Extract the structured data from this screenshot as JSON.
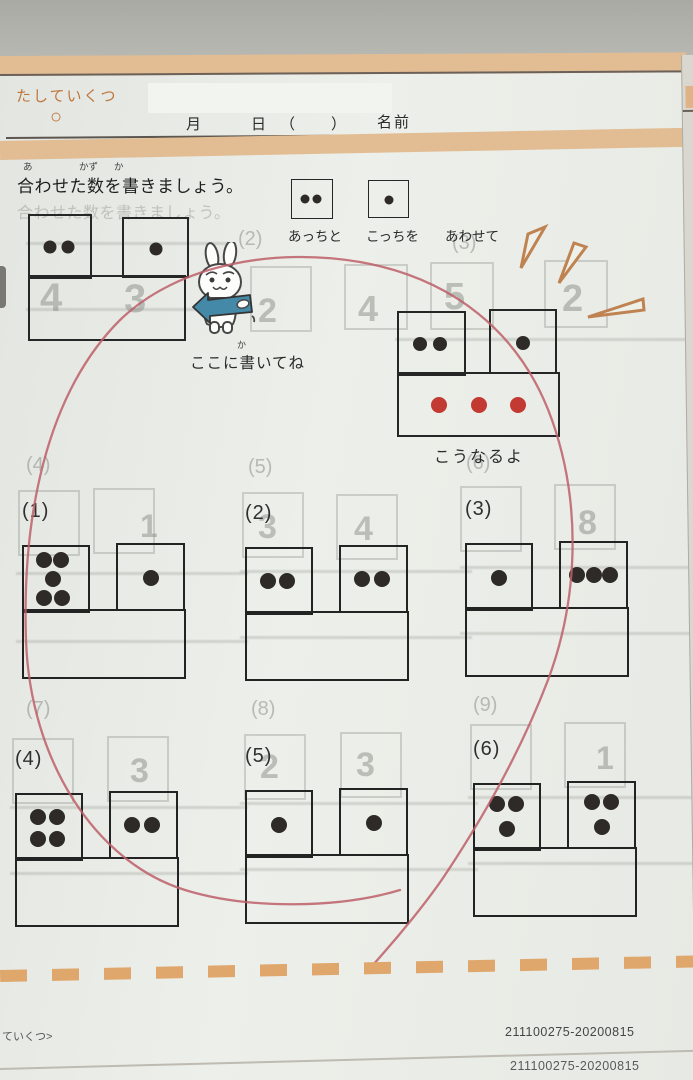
{
  "colors": {
    "accent_orange_bar": "#e2bc92",
    "title_orange": "#c0763e",
    "red_pen": "#bd5f68",
    "dot_black": "#2e2a27",
    "dot_red": "#c23a32",
    "arrow_blue": "#4589a8",
    "burst_orange": "#bf8352"
  },
  "header": {
    "title": "たしていくつ",
    "title_mark": "○",
    "month": "月",
    "day": "日",
    "paren_open": "（",
    "paren_close": "）",
    "name": "名前"
  },
  "instruction": {
    "furigana": [
      "あ",
      "かず",
      "か"
    ],
    "text": "合わせた数を書きましょう。",
    "ghost_text": "合わせた数を書きましょう。"
  },
  "legend": {
    "box_a": {
      "count": 2,
      "pattern": "row2"
    },
    "box_b": {
      "count": 1,
      "pattern": "one"
    },
    "captions": [
      "あっちと",
      "こっちを",
      "あわせて"
    ]
  },
  "example_problem": {
    "left": {
      "count": 2,
      "pattern": "row2"
    },
    "right": {
      "count": 1,
      "pattern": "one"
    }
  },
  "rabbit_note": {
    "furigana": "か",
    "text": "ここに書いてね"
  },
  "example_result": {
    "left": {
      "count": 2,
      "pattern": "row2"
    },
    "right": {
      "count": 1,
      "pattern": "one"
    },
    "sum": {
      "count": 3,
      "pattern": "row3",
      "color": "#c23a32"
    },
    "caption": "こうなるよ"
  },
  "problems": [
    {
      "label": "(1)",
      "left": {
        "count": 5,
        "pattern": "five"
      },
      "right": {
        "count": 1,
        "pattern": "one"
      }
    },
    {
      "label": "(2)",
      "left": {
        "count": 2,
        "pattern": "row2"
      },
      "right": {
        "count": 2,
        "pattern": "row2"
      }
    },
    {
      "label": "(3)",
      "left": {
        "count": 1,
        "pattern": "one"
      },
      "right": {
        "count": 3,
        "pattern": "row3"
      }
    },
    {
      "label": "(4)",
      "left": {
        "count": 4,
        "pattern": "grid4"
      },
      "right": {
        "count": 2,
        "pattern": "row2"
      }
    },
    {
      "label": "(5)",
      "left": {
        "count": 1,
        "pattern": "one"
      },
      "right": {
        "count": 1,
        "pattern": "one"
      }
    },
    {
      "label": "(6)",
      "left": {
        "count": 3,
        "pattern": "tri3"
      },
      "right": {
        "count": 3,
        "pattern": "tri3"
      }
    }
  ],
  "ghost": {
    "labels": [
      {
        "text": "(2)"
      },
      {
        "text": "(3)"
      },
      {
        "text": "(4)"
      },
      {
        "text": "(5)"
      },
      {
        "text": "(6)"
      },
      {
        "text": "(7)"
      },
      {
        "text": "(8)"
      },
      {
        "text": "(9)"
      }
    ],
    "numbers": [
      {
        "text": "4"
      },
      {
        "text": "3"
      },
      {
        "text": "2"
      },
      {
        "text": "4"
      },
      {
        "text": "5"
      },
      {
        "text": "2"
      },
      {
        "text": "1"
      },
      {
        "text": "3"
      },
      {
        "text": "4"
      },
      {
        "text": "8"
      },
      {
        "text": "3"
      },
      {
        "text": "2"
      },
      {
        "text": "3"
      },
      {
        "text": "1"
      }
    ]
  },
  "footer": {
    "left_text": "ていくつ>",
    "code": "211100275-20200815",
    "code_under": "211100275-20200815"
  }
}
